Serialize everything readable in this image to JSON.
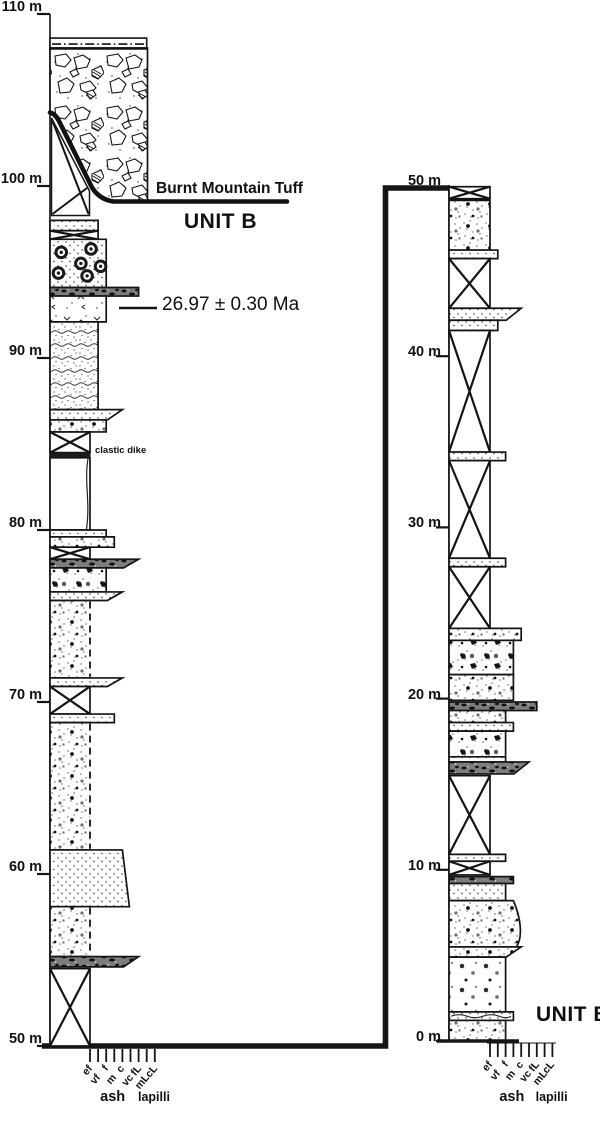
{
  "figure": {
    "annotations": {
      "burnt_mountain_tuff": "Burnt Mountain Tuff",
      "unit_b_upper": "UNIT B",
      "unit_b_lower": "UNIT B",
      "age": "26.97 ± 0.30 Ma",
      "clastic_dike": "clastic dike"
    },
    "grain_size": {
      "tick_labels": [
        "ef",
        "vf",
        "f",
        "m",
        "c",
        "vc",
        "fL",
        "mL",
        "cL"
      ],
      "group_labels": [
        "ash",
        "lapilli"
      ]
    },
    "left_column": {
      "top_m": 110,
      "base_m": 50,
      "depth_ticks": [
        "110 m",
        "100 m",
        "90 m",
        "80 m",
        "70 m",
        "60 m",
        "50 m"
      ],
      "units": [
        {
          "top": 108.6,
          "base": 107.9,
          "g": 8,
          "lith": "dashdot"
        },
        {
          "top": 107.9,
          "base": 98.9,
          "g": 8,
          "lith": "breccia",
          "shape": "breccia"
        },
        {
          "top": 98.0,
          "base": 97.4,
          "g": 2,
          "lith": "tuff"
        },
        {
          "top": 97.4,
          "base": 96.9,
          "g": 2,
          "lith": "covered"
        },
        {
          "top": 96.9,
          "base": 94.1,
          "g": 3,
          "lith": "accretionary"
        },
        {
          "top": 94.1,
          "base": 93.6,
          "g": 7,
          "lith": "dark"
        },
        {
          "top": 93.6,
          "base": 92.1,
          "g": 3,
          "lith": "fiamme"
        },
        {
          "top": 92.1,
          "base": 87.0,
          "g": 2,
          "lith": "laminated"
        },
        {
          "top": 87.0,
          "base": 86.4,
          "g": 5,
          "lith": "tuff",
          "shape": "tail"
        },
        {
          "top": 86.4,
          "base": 85.7,
          "g": 3,
          "lith": "lapilli"
        },
        {
          "top": 85.7,
          "base": 84.5,
          "g": 1,
          "lith": "covered"
        },
        {
          "top": 84.5,
          "base": 84.2,
          "g": 1,
          "lith": "black"
        },
        {
          "top": 84.2,
          "base": 80.0,
          "g": 1,
          "lith": "blank",
          "dike": true
        },
        {
          "top": 80.0,
          "base": 79.6,
          "g": 3,
          "lith": "tuff"
        },
        {
          "top": 79.6,
          "base": 79.0,
          "g": 4,
          "lith": "lapilli"
        },
        {
          "top": 79.0,
          "base": 78.3,
          "g": 1,
          "lith": "covered"
        },
        {
          "top": 78.3,
          "base": 77.8,
          "g": 7,
          "lith": "dark",
          "shape": "tail"
        },
        {
          "top": 77.8,
          "base": 76.4,
          "g": 3,
          "lith": "coarse"
        },
        {
          "top": 76.4,
          "base": 75.9,
          "g": 5,
          "lith": "tuff",
          "shape": "tail"
        },
        {
          "top": 75.9,
          "base": 71.4,
          "g": 1,
          "lith": "lapilli",
          "rightDashed": true
        },
        {
          "top": 71.4,
          "base": 70.9,
          "g": 5,
          "lith": "tuff",
          "shape": "tail"
        },
        {
          "top": 70.9,
          "base": 69.3,
          "g": 1,
          "lith": "covered"
        },
        {
          "top": 69.3,
          "base": 68.8,
          "g": 4,
          "lith": "tuff"
        },
        {
          "top": 68.8,
          "base": 61.4,
          "g": 1,
          "lith": "lapilli",
          "rightDashed": true
        },
        {
          "top": 61.4,
          "base": 58.1,
          "g": 5,
          "lith": "tuff",
          "shape": "trap"
        },
        {
          "top": 58.1,
          "base": 55.2,
          "g": 1,
          "lith": "lapilli",
          "rightDashed": true
        },
        {
          "top": 55.2,
          "base": 54.6,
          "g": 7,
          "lith": "dark",
          "shape": "tail"
        },
        {
          "top": 54.5,
          "base": 50.0,
          "g": 1,
          "lith": "covered"
        }
      ]
    },
    "right_column": {
      "top_m": 50,
      "base_m": 0,
      "depth_ticks": [
        "50 m",
        "40 m",
        "30 m",
        "20 m",
        "10 m",
        "0 m"
      ],
      "units": [
        {
          "top": 49.9,
          "base": 49.2,
          "g": 1,
          "lith": "covered"
        },
        {
          "top": 49.1,
          "base": 46.2,
          "g": 1,
          "lith": "lapilli"
        },
        {
          "top": 46.2,
          "base": 45.7,
          "g": 2,
          "lith": "tuff"
        },
        {
          "top": 45.7,
          "base": 42.8,
          "g": 1,
          "lith": "covered"
        },
        {
          "top": 42.8,
          "base": 42.1,
          "g": 5,
          "lith": "tuff",
          "shape": "tail"
        },
        {
          "top": 42.1,
          "base": 41.5,
          "g": 2,
          "lith": "tuff"
        },
        {
          "top": 41.5,
          "base": 34.4,
          "g": 1,
          "lith": "covered"
        },
        {
          "top": 34.4,
          "base": 33.9,
          "g": 3,
          "lith": "tuff"
        },
        {
          "top": 33.9,
          "base": 28.2,
          "g": 1,
          "lith": "covered"
        },
        {
          "top": 28.2,
          "base": 27.7,
          "g": 3,
          "lith": "tuff"
        },
        {
          "top": 27.7,
          "base": 24.1,
          "g": 1,
          "lith": "covered"
        },
        {
          "top": 24.1,
          "base": 23.4,
          "g": 5,
          "lith": "lapilli"
        },
        {
          "top": 23.4,
          "base": 21.4,
          "g": 4,
          "lith": "coarse"
        },
        {
          "top": 21.4,
          "base": 19.9,
          "g": 4,
          "lith": "lapilli"
        },
        {
          "top": 19.8,
          "base": 19.3,
          "g": 7,
          "lith": "dark"
        },
        {
          "top": 19.3,
          "base": 18.6,
          "g": 3,
          "lith": "lapilli"
        },
        {
          "top": 18.6,
          "base": 18.1,
          "g": 4,
          "lith": "tuff"
        },
        {
          "top": 18.1,
          "base": 16.6,
          "g": 3,
          "lith": "coarse"
        },
        {
          "top": 16.6,
          "base": 16.3,
          "g": 3,
          "lith": "tuff"
        },
        {
          "top": 16.3,
          "base": 15.6,
          "g": 6,
          "lith": "dark",
          "shape": "tail"
        },
        {
          "top": 15.5,
          "base": 10.9,
          "g": 1,
          "lith": "covered"
        },
        {
          "top": 10.9,
          "base": 10.5,
          "g": 3,
          "lith": "tuff"
        },
        {
          "top": 10.5,
          "base": 9.7,
          "g": 1,
          "lith": "covered"
        },
        {
          "top": 9.6,
          "base": 9.2,
          "g": 4,
          "lith": "dark"
        },
        {
          "top": 9.2,
          "base": 8.2,
          "g": 3,
          "lith": "tuff"
        },
        {
          "top": 8.2,
          "base": 5.5,
          "g": 4,
          "lith": "lapilli",
          "shape": "curveR"
        },
        {
          "top": 5.5,
          "base": 4.9,
          "g": 5,
          "lith": "lapilli",
          "shape": "tail"
        },
        {
          "top": 4.9,
          "base": 1.7,
          "g": 3,
          "lith": "scatter"
        },
        {
          "top": 1.7,
          "base": 1.2,
          "g": 4,
          "lith": "tuff",
          "wavy": true
        },
        {
          "top": 1.2,
          "base": 0.0,
          "g": 3,
          "lith": "lapilli"
        }
      ]
    }
  }
}
